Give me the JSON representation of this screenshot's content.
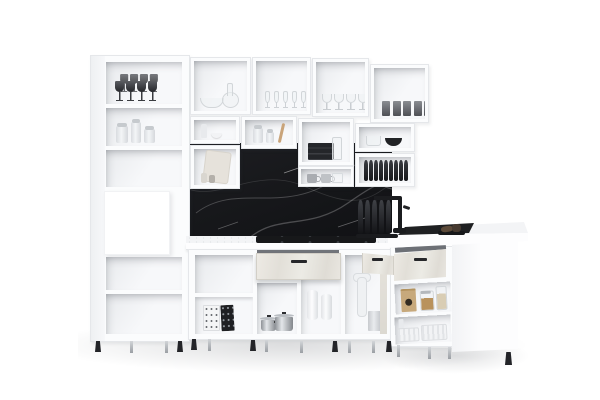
{
  "scene": {
    "type": "3d-product-render",
    "subject": "White modular L-shaped kitchen with open shelving cubbies, black marble backsplash, cooktop, black faucet and open drawers",
    "text_visible": "none"
  },
  "colors": {
    "bg": "#ffffff",
    "cab": "#fbfcfd",
    "edge": "#e5e7ea",
    "in1": "#f7f8fa",
    "in2": "#e8eaed",
    "marble": "#17181b",
    "countertop": "#f3f4f6",
    "counterfront": "#fdfdfe",
    "drawer": "#e9e6df",
    "draweredge": "#d2cfc7",
    "handle": "#26272a",
    "dark": "#212226",
    "steelL": "#e3e6e9",
    "steelD": "#8e9297",
    "glassline": "#d2d6d9",
    "smokeL": "#5a5c61",
    "smokeD": "#26272b",
    "wood": "#c9a47a",
    "kraft": "#c7a97c",
    "leg": "#c7cacd",
    "foot": "#232428"
  },
  "inventory": {
    "tall_cabinet": [
      "smoked stemware",
      "storage jars",
      "empty shelf",
      "white oven niche",
      "empty shelf",
      "empty shelf"
    ],
    "upper_cubbies": [
      "glass bowl and decanter",
      "champagne flutes",
      "wine glasses",
      "smoked tumblers"
    ],
    "middle_cubbies": [
      "small bottle and white bowl",
      "cutting board and shakers",
      "spice jars and wooden spoon",
      "black napkin stack and glass bottle",
      "glass cup and black bowl",
      "gray mugs",
      "black plate rack"
    ],
    "counter_items": [
      "black cooktop",
      "black faucet",
      "black sink mat",
      "dish brush set",
      "drying plates rack"
    ],
    "base_cabinets": [
      "patterned storage boxes",
      "steel pots",
      "open concrete-look drawer",
      "paper towel rolls",
      "drain pipe and bin",
      "two open drawers right",
      "food jar and kraft bag",
      "white storage baskets",
      "white end panel"
    ]
  }
}
